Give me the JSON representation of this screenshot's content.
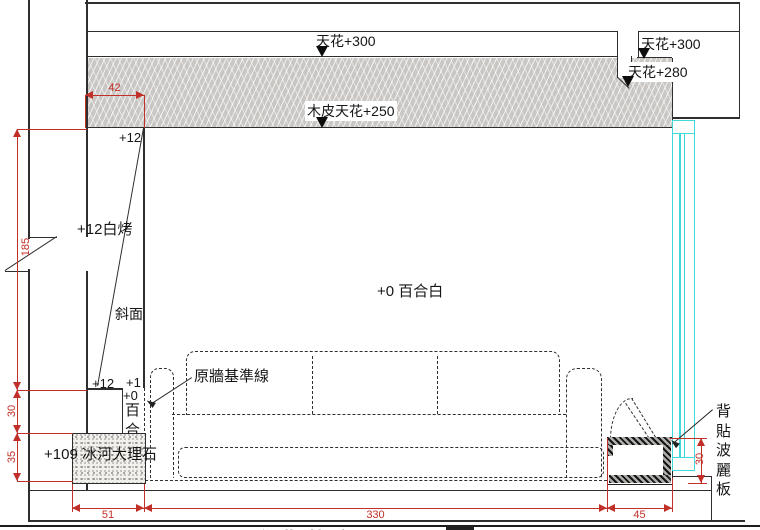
{
  "drawing": {
    "title_partial": "沙發背牆立面圖",
    "labels": {
      "ceiling300_mid": "天花+300",
      "ceiling300_right": "天花+300",
      "ceiling280_right": "天花+280",
      "wood_ceiling250": "木皮天花+250",
      "plus12_top": "+12",
      "plus12_white_bake": "+12白烤",
      "slope_face": "斜面",
      "plus12_bottom": "+12",
      "plus1_bottom": "+1",
      "plus0_bottom": "+0",
      "lily_white_column": "百合白",
      "wall_finish": "+0 百合白",
      "orig_wall_datum": "原牆基準線",
      "marble_base": "+109 冰河大理石",
      "poly_board_back": "背貼波麗板"
    },
    "dims": {
      "d42": "42",
      "d185": "185",
      "d30_left": "30",
      "d35": "35",
      "d51": "51",
      "d330": "330",
      "d45": "45",
      "d30_right": "30"
    },
    "colors": {
      "line": "#2e2e2e",
      "dim_red": "#c03028",
      "hatch_fill": "#c9c6c3",
      "glass_cyan": "#3fd9d9"
    }
  }
}
